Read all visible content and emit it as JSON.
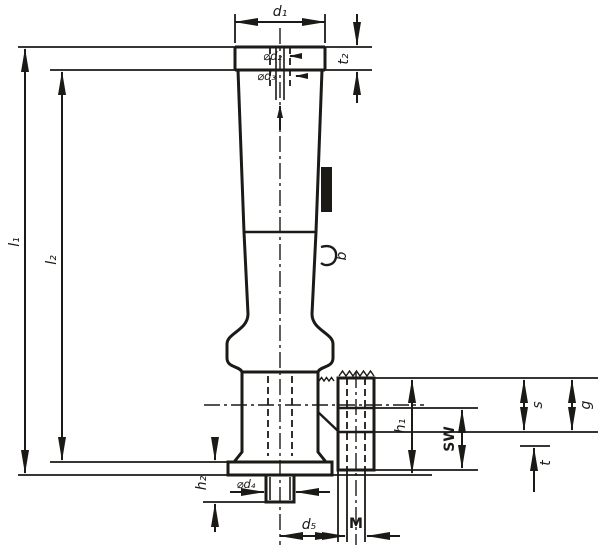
{
  "drawing": {
    "background": "#ffffff",
    "line_color": "#1c1a17",
    "labels": {
      "d1": "d₁",
      "d2": "⌀d₂",
      "d3": "⌀d₃",
      "t2": "t₂",
      "l1": "l₁",
      "l2": "l₂",
      "b": "b",
      "h1": "h₁",
      "sw": "SW",
      "s": "s",
      "g": "g",
      "t": "t",
      "h2": "h₂",
      "d4": "⌀d₄",
      "d5": "d₅",
      "m": "M"
    }
  }
}
